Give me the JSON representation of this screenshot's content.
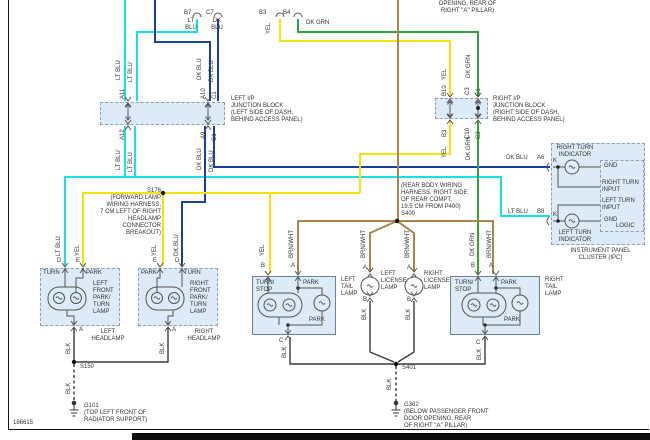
{
  "doc_number": "186615",
  "colors": {
    "lt_blu": "#17E0E8",
    "dk_blu": "#1B3FA0",
    "yel": "#F2E30A",
    "dk_grn": "#2EA440",
    "brn_wht": "#A9854C",
    "blk": "#3A3A3A",
    "internal": "#5A6B7A",
    "box_fill": "#DCEBF7"
  },
  "w": {
    "lt_blu": "LT BLU",
    "dk_blu": "DK BLU",
    "yel": "YEL",
    "dk_grn": "DK GRN",
    "brn_wht": "BRN/WHT",
    "blk": "BLK"
  },
  "p": {
    "a11": "A11",
    "a12": "A12",
    "a10": "A10",
    "a9": "A9",
    "c1": "C1",
    "b10": "B10",
    "c3": "C3",
    "c10": "C10",
    "c2": "C2",
    "b3": "B3",
    "b4": "B4",
    "b7": "B7",
    "c7": "C7",
    "d": "D",
    "e": "E",
    "a": "A",
    "b": "B",
    "c": "C",
    "k": "K",
    "a6": "A6",
    "b8": "B8"
  },
  "top": {
    "b7_color": "LT\nBLU",
    "c7_color": "DK\nBLU",
    "dk_grn_label": "DK GRN",
    "note": "OPENING, REAR OF\nRIGHT ''A'' PILLAR)"
  },
  "jb": {
    "left": "LEFT I/P\nJUNCTION BLOCK\n(LEFT SIDE OF DASH,\nBEHIND ACCESS PANEL)",
    "right": "RIGHT I/P\nJUNCTION BLOCK\n(RIGHT SIDE OF DASH,\nBEHIND ACCESS PANEL)"
  },
  "sp": {
    "s176": "S176\n(FORWARD LAMP\nWIRING HARNESS,\n7 CM LEFT OF RIGHT\nHEADLAMP CONNECTOR\nBREAKOUT)",
    "s400": "(REAR BODY WIRING\nHARNESS, RIGHT SIDE\nOF REAR COMPT,\n19.5 CM FROM P400)\nS400",
    "s150": "S150",
    "s401": "S401"
  },
  "gnd": {
    "g101": "G101\n(TOP LEFT FRONT OF\nRADIATOR SUPPORT)",
    "g302": "G302\n(BELOW PASSENGER FRONT\nDOOR OPENING, REAR\nOF RIGHT ''A'' PILLAR)"
  },
  "lamp": {
    "turn": "TURN",
    "park": "PARK",
    "turn_stop": "TURN/\nSTOP",
    "left_front": "LEFT\nFRONT\nPARK/\nTURN\nLAMP",
    "right_front": "RIGHT\nFRONT\nPARK/\nTURN\nLAMP",
    "left_headlamp": "LEFT\nHEADLAMP",
    "right_headlamp": "RIGHT\nHEADLAMP",
    "left_tail": "LEFT\nTAIL\nLAMP",
    "right_tail": "RIGHT\nTAIL\nLAMP",
    "left_license": "LEFT\nLICENSE\nLAMP",
    "right_license": "RIGHT\nLICENSE\nLAMP"
  },
  "ipc": {
    "right_turn_indicator": "RIGHT TURN\nINDICATOR",
    "left_turn_indicator": "LEFT TURN\nINDICATOR",
    "gnd": "GND",
    "right_turn_input": "RIGHT TURN\nINPUT",
    "left_turn_input": "LEFT TURN\nINPUT",
    "logic": "LOGIC",
    "title": "INSTRUMENT PANEL\nCLUSTER (IPC)"
  }
}
